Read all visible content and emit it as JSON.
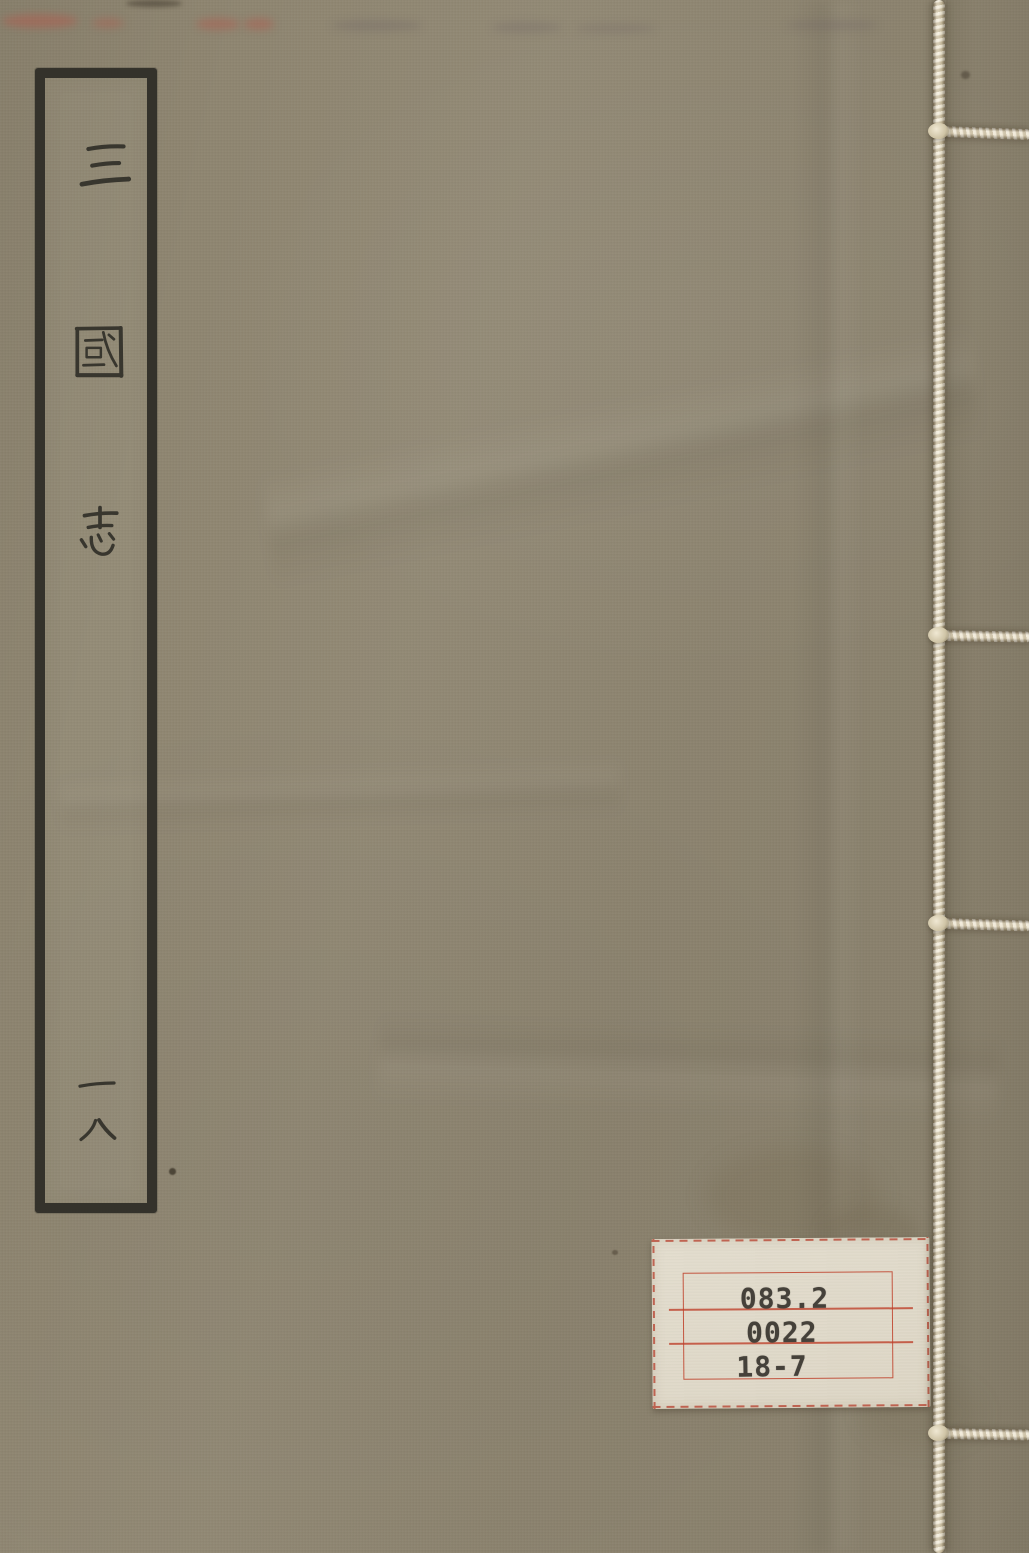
{
  "book_cover": {
    "title_label": {
      "title": "三國志",
      "volume": "一八"
    },
    "call_number_label": {
      "lines": [
        "083.2",
        "0022",
        "18-7"
      ]
    }
  },
  "colors": {
    "cover_fabric": "#8f8671",
    "title_ink": "#34322b",
    "thread": "#ece3cd",
    "call_label_paper": "#e3ddce",
    "call_label_red": "#b7402e",
    "call_label_text": "#45413a"
  }
}
